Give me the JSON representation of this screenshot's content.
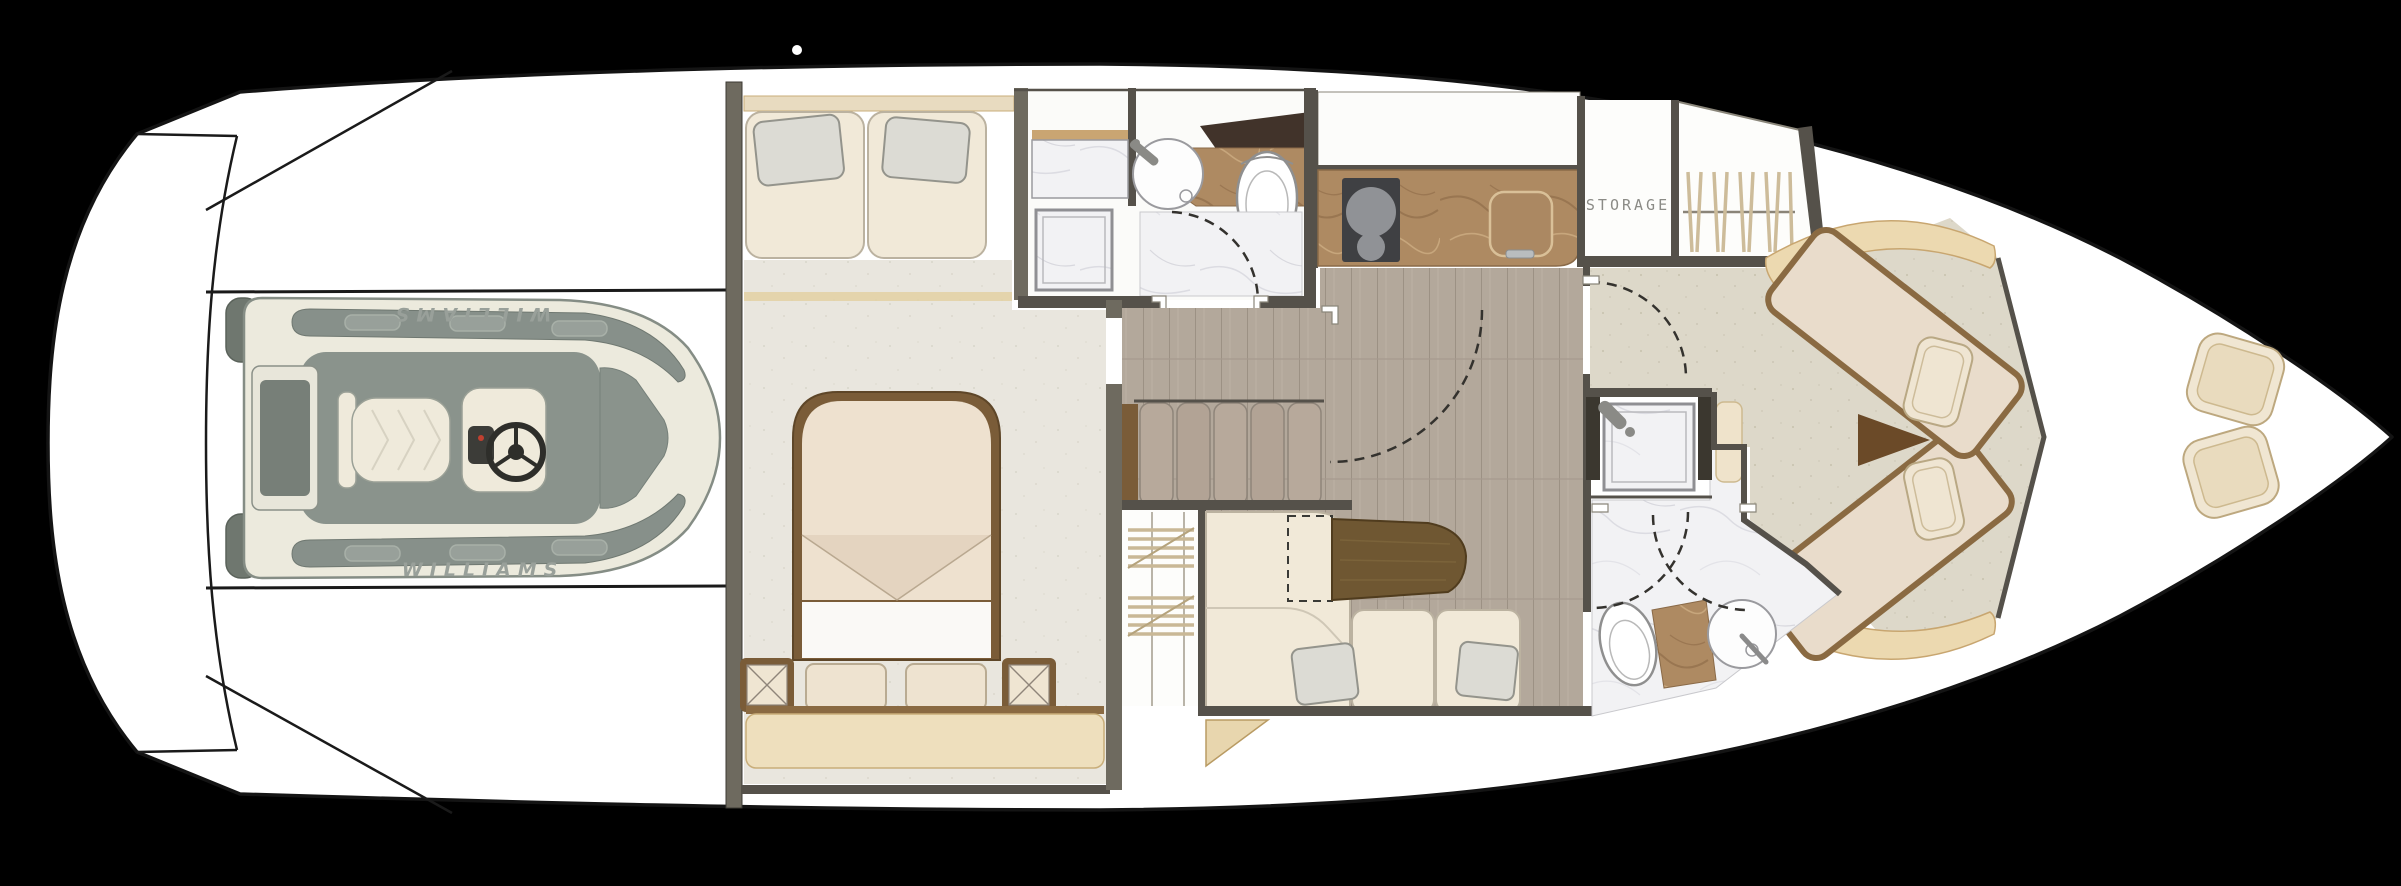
{
  "diagram": {
    "type": "yacht-lower-deck-floor-plan",
    "orientation": "bow-right-stern-left",
    "labels": {
      "storage": "STORAGE",
      "tender_brand_top": "WILLIAMS",
      "tender_brand_bottom": "WILLIAMS"
    },
    "areas": [
      "tender-garage-with-williams-jet-tender",
      "swim-platform",
      "master-cabin",
      "master-berth",
      "aft-head-with-shower-sink-toilet",
      "companionway-stairs",
      "hanging-wardrobe",
      "salon-l-sofa",
      "salon-table",
      "galley-counter-with-cooktop-and-sink",
      "storage-room",
      "forward-hanging-locker",
      "forward-vip-cabin-crossed-berths",
      "forward-head-with-shower-sink-toilet",
      "foredeck-seat-pads"
    ],
    "fixture_icons": [
      "toilet-icon",
      "round-sink-icon",
      "shower-head-icon",
      "cooktop-burners-icon",
      "steering-wheel-icon",
      "clothes-hangers-icon",
      "door-swing-arc-icon",
      "nightstand-x-icon"
    ]
  },
  "colors": {
    "background": "#000000",
    "hull": "#ffffff",
    "outline": "#161616",
    "wall": "#6e6a5f",
    "wall_dark": "#55514a",
    "carpet": "#e9e6de",
    "carpet_bow": "#ddd8c9",
    "wood": "#b3a89b",
    "upholstery": "#f1e9d8",
    "upholstery_border": "#b9b09e",
    "tan": "#ecd9b0",
    "tan_deep": "#e2cf9f",
    "wood_trim": "#7a5c38",
    "table_wood": "#6f5732",
    "marble": "#f2f2f4",
    "brown_marble": "#ae8a62",
    "backsplash": "#41332a",
    "cooktop": "#3f4043",
    "burner": "#909296",
    "pillow": "#dcdbd4",
    "tender_body": "#eceadd",
    "tender_pad": "#87908a",
    "tender_dark": "#6f776f",
    "text_gray": "#8b8b86",
    "brand_gray": "#99a09a"
  }
}
